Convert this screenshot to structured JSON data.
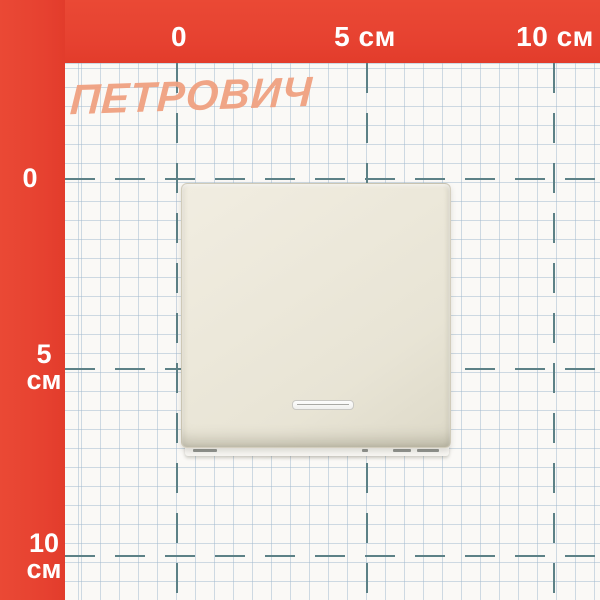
{
  "watermark": {
    "text": "ПЕТРОВИЧ",
    "color": "#f0a181"
  },
  "ruler": {
    "band_color": "#e74330",
    "text_color": "#ffffff",
    "unit": "см",
    "top_labels": [
      "0",
      "5 см",
      "10 см"
    ],
    "left_labels": [
      {
        "num": "0",
        "unit": ""
      },
      {
        "num": "5",
        "unit": "см"
      },
      {
        "num": "10",
        "unit": "см"
      }
    ]
  },
  "grid": {
    "background": "#faf9f6",
    "fine_line_color": "#a0b9cd",
    "major_line_color": "#5c8186",
    "fine_cell_px": 19,
    "major_interval_cm": 5
  },
  "product": {
    "kind": "rocker-light-switch-with-indicator",
    "body_color": "#ebe7d9",
    "indicator_frame_color": "#c9c8c3"
  }
}
